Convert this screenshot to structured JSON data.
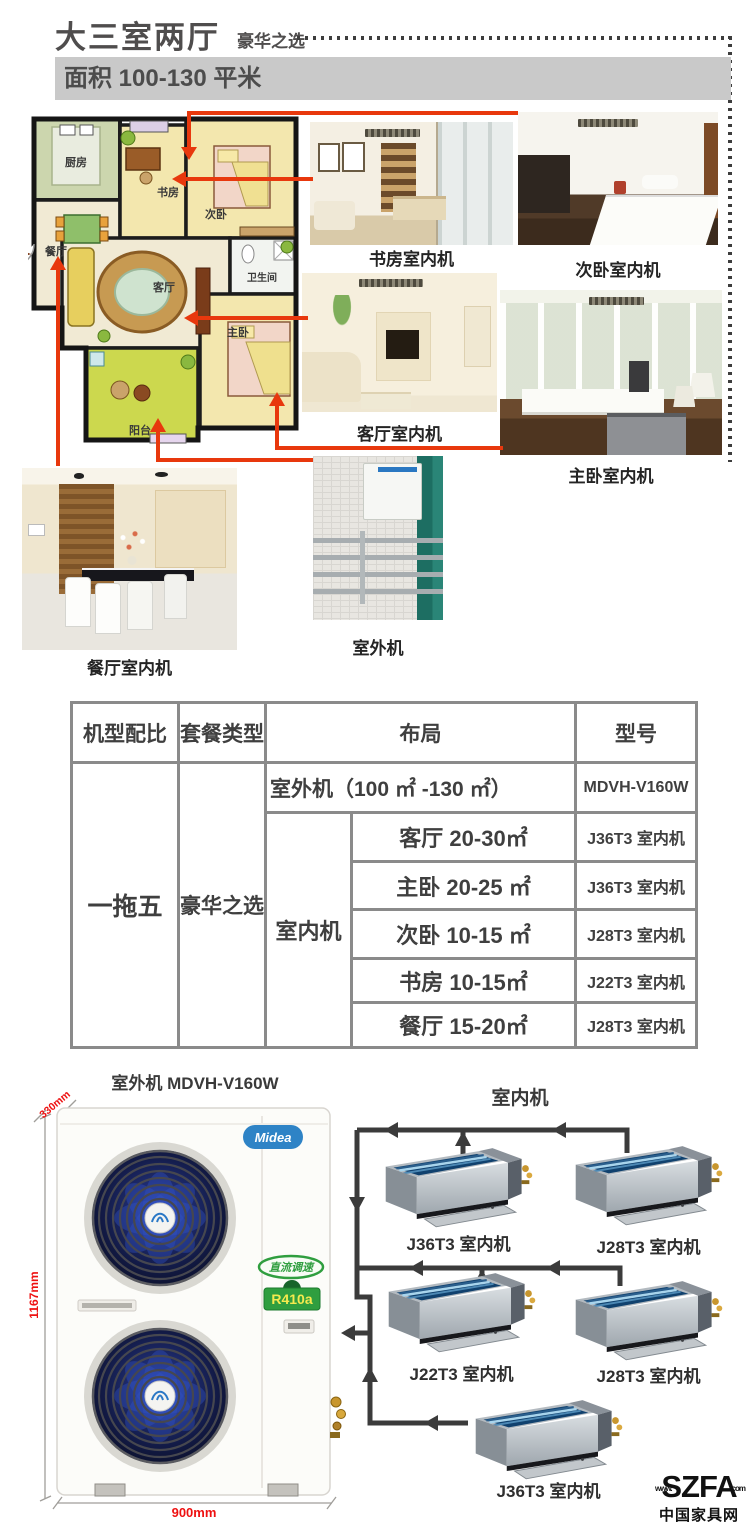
{
  "header": {
    "title": "大三室两厅",
    "subtitle": "豪华之选",
    "banner": "面积 100-130 平米"
  },
  "floorplan": {
    "rooms": [
      "厨房",
      "书房",
      "次卧",
      "餐厅",
      "客厅",
      "卫生间",
      "主卧",
      "阳台"
    ]
  },
  "photos": {
    "study": {
      "label": "书房室内机"
    },
    "second_bedroom": {
      "label": "次卧室内机"
    },
    "living": {
      "label": "客厅室内机"
    },
    "master": {
      "label": "主卧室内机"
    },
    "dining": {
      "label": "餐厅室内机"
    },
    "outdoor": {
      "label": "室外机"
    }
  },
  "table": {
    "headers": [
      "机型配比",
      "套餐类型",
      "布局",
      "型号"
    ],
    "config": "一拖五",
    "package": "豪华之选",
    "outdoor_layout": "室外机（100 ㎡ -130 ㎡）",
    "outdoor_model": "MDVH-V160W",
    "indoor_label": "室内机",
    "indoor_rows": [
      {
        "room": "客厅 20-30㎡",
        "model": "J36T3 室内机"
      },
      {
        "room": "主卧 20-25 ㎡",
        "model": "J36T3 室内机"
      },
      {
        "room": "次卧 10-15 ㎡",
        "model": "J28T3 室内机"
      },
      {
        "room": "书房 10-15㎡",
        "model": "J22T3 室内机"
      },
      {
        "room": "餐厅 15-20㎡",
        "model": "J28T3 室内机"
      }
    ]
  },
  "diagram": {
    "outdoor_heading": "室外机 MDVH-V160W",
    "indoor_heading": "室内机",
    "brand": "Midea",
    "badge_dc": "直流调速",
    "badge_refrigerant": "R410a",
    "dim_height": "1167mm",
    "dim_width": "900mm",
    "dim_depth": "330mm",
    "units": [
      {
        "label": "J36T3 室内机"
      },
      {
        "label": "J28T3 室内机"
      },
      {
        "label": "J22T3 室内机"
      },
      {
        "label": "J28T3 室内机"
      },
      {
        "label": "J36T3 室内机"
      }
    ]
  },
  "footer": {
    "logo": "SZFA",
    "logo_www": "www.",
    "logo_com": ".com",
    "caption": "中国家具网"
  },
  "colors": {
    "accent_red": "#e8380d",
    "dimension_red": "#ee1111",
    "banner_gray": "#c9c9c9",
    "table_border": "#8a8a8a",
    "line_dark": "#3b3b3b",
    "midea_blue": "#2e83c6",
    "eco_green": "#2f9e3f"
  }
}
